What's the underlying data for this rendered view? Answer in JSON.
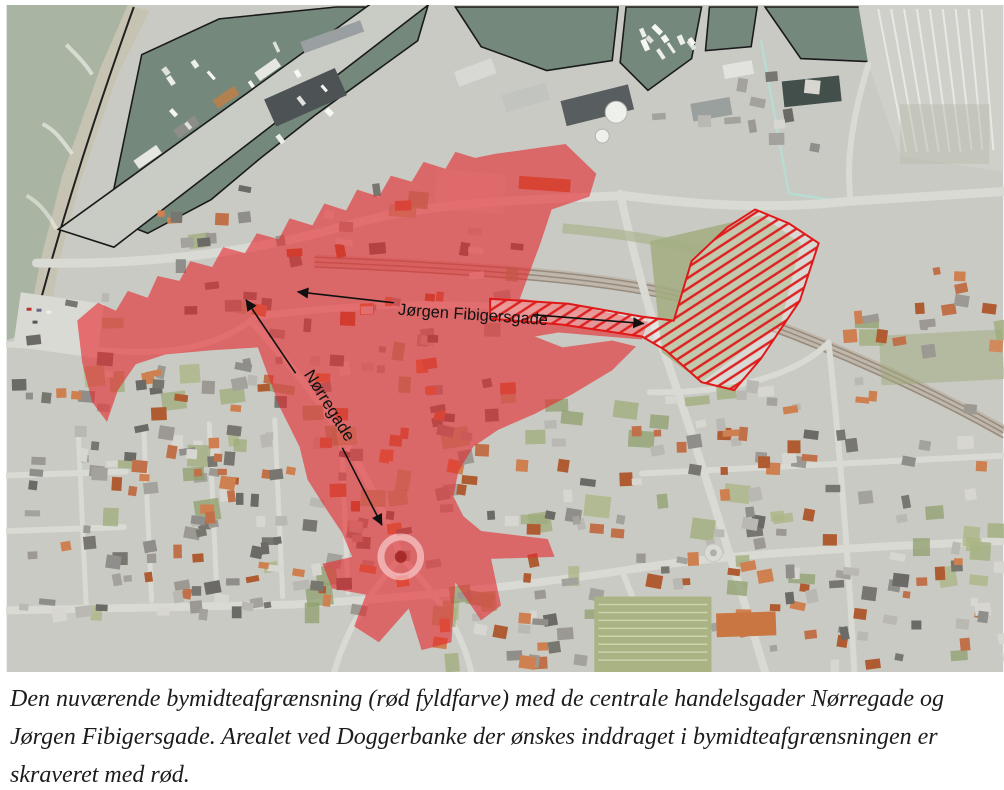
{
  "figure": {
    "street_labels": {
      "jorgen": "Jørgen Fibigersgade",
      "norregade": "Nørregade"
    },
    "colors": {
      "city_center_fill": "#e8262b",
      "hatch_red": "#e01818",
      "harbor_water": "#74897c",
      "sea": "#a9b4a3"
    }
  },
  "caption": {
    "lines": [
      "Den nuværende bymidteafgrænsning (rød fyldfarve) med de centrale handelsgader Nørregade og",
      "Jørgen Fibigersgade. Arealet ved Doggerbanke der ønskes inddraget i bymidteafgrænsningen er",
      "skraveret med rød."
    ]
  }
}
